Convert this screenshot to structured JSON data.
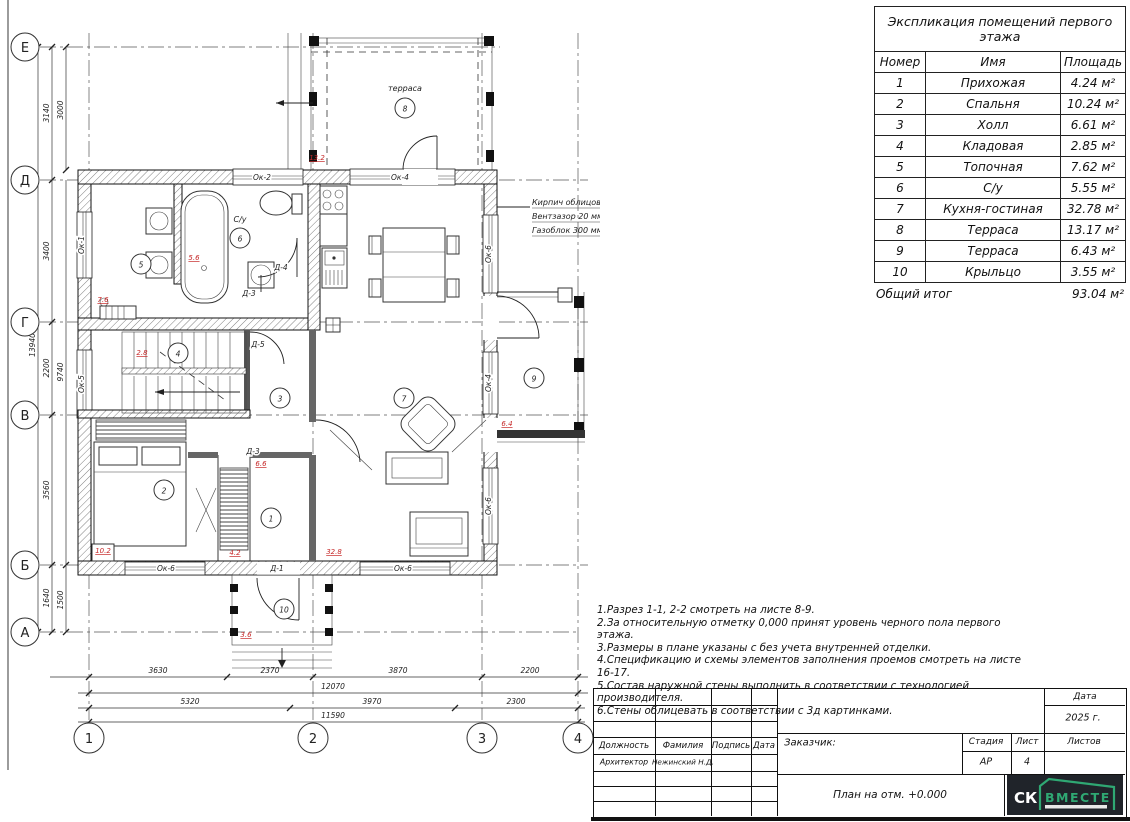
{
  "plan": {
    "row_axes": [
      "Е",
      "Д",
      "Г",
      "В",
      "Б",
      "А"
    ],
    "col_axes": [
      "1",
      "2",
      "3",
      "4"
    ],
    "terrace_label": "терраса",
    "wc_label": "С/у",
    "room_numbers": [
      "1",
      "2",
      "3",
      "4",
      "5",
      "6",
      "7",
      "8",
      "9",
      "10"
    ],
    "red_areas": [
      "13.2",
      "7.6",
      "5.6",
      "2.8",
      "6.6",
      "10.2",
      "4.2",
      "32.8",
      "3.6",
      "6.4"
    ],
    "window_labels": [
      "Ок-2",
      "Ок-4",
      "Ок-1",
      "Ок-5",
      "Ок-6",
      "Ок-4",
      "Ок-6",
      "Ок-6",
      "Ок-6",
      "Д-1"
    ],
    "door_labels": [
      "Д-4",
      "Д-3",
      "Д-5",
      "Д-3"
    ],
    "wall_callout": [
      "Кирпич облицовочный 120 мм",
      "Вентзазор 20 мм",
      "Газоблок 300 мм"
    ],
    "dims_bottom_row1": [
      "3630",
      "2370",
      "3870",
      "2200"
    ],
    "dims_bottom_row2": "12070",
    "dims_bottom_row3": [
      "5320",
      "3970",
      "2300"
    ],
    "dims_bottom_row4": "11590",
    "dims_left_total": "13940",
    "dims_left_segments": [
      "3140",
      "3400",
      "2200",
      "3560",
      "1640"
    ],
    "dims_left_inner": [
      "3000",
      "9740",
      "1500"
    ]
  },
  "table": {
    "title": "Экспликация помещений первого этажа",
    "headers": [
      "Номер",
      "Имя",
      "Площадь"
    ],
    "rows": [
      [
        "1",
        "Прихожая",
        "4.24 м²"
      ],
      [
        "2",
        "Спальня",
        "10.24 м²"
      ],
      [
        "3",
        "Холл",
        "6.61 м²"
      ],
      [
        "4",
        "Кладовая",
        "2.85 м²"
      ],
      [
        "5",
        "Топочная",
        "7.62 м²"
      ],
      [
        "6",
        "С/у",
        "5.55 м²"
      ],
      [
        "7",
        "Кухня-гостиная",
        "32.78 м²"
      ],
      [
        "8",
        "Терраса",
        "13.17 м²"
      ],
      [
        "9",
        "Терраса",
        "6.43 м²"
      ],
      [
        "10",
        "Крыльцо",
        "3.55 м²"
      ]
    ],
    "total_label": "Общий итог",
    "total_value": "93.04 м²"
  },
  "notes": [
    "1.Разрез 1-1, 2-2 смотреть на листе 8-9.",
    "2.За относительную отметку 0,000 принят уровень черного пола первого этажа.",
    "3.Размеры в плане указаны с без учета внутренней отделки.",
    "4.Спецификацию и схемы элементов заполнения  проемов смотреть на листе 16-17.",
    "5.Состав наружной стены выполнить в соответствии с технологией производителя.",
    "6.Стены  облицевать  в соответствии с 3д картинками."
  ],
  "titleblock": {
    "date_label": "Дата",
    "year": "2025 г.",
    "col_headers": [
      "Должность",
      "Фамилия",
      "Подпись",
      "Дата"
    ],
    "role": "Архитектор",
    "name": "Нежинский Н.Д.",
    "customer_label": "Заказчик:",
    "stage_label": "Стадия",
    "sheet_label": "Лист",
    "sheets_label": "Листов",
    "stage": "АР",
    "sheet": "4",
    "drawing_title": "План на отм. +0.000",
    "logo_sk": "СК",
    "logo_vmeste": "ВМЕСТЕ",
    "accent_green": "#2fa873",
    "logo_bg": "#20242a"
  }
}
